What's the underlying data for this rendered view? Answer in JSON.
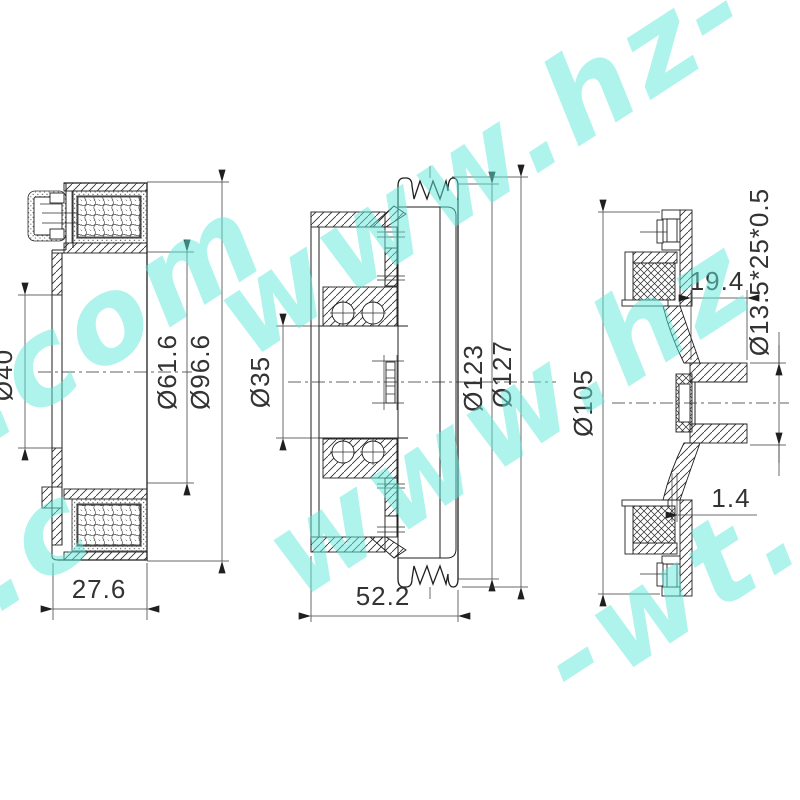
{
  "watermark": {
    "text": "www.hz-wt.com",
    "color": "#5fe8db",
    "fragments": [
      {
        "text": "t.com"
      },
      {
        "text": "www.hz-"
      },
      {
        "text": "www.hz"
      },
      {
        "text": "-wt."
      },
      {
        "text": "t.c"
      }
    ]
  },
  "views": {
    "coil": {
      "dims": {
        "bore": "Ø40",
        "coil_inner": "Ø61.6",
        "outer": "Ø96.6",
        "width": "27.6"
      }
    },
    "pulley": {
      "dims": {
        "bore": "Ø35",
        "groove_root": "Ø123",
        "outer": "Ø127",
        "width": "52.2"
      }
    },
    "hub": {
      "dims": {
        "outer": "Ø105",
        "hub_depth": "19.4",
        "bearing_spec": "Ø13.5*25*0.5",
        "air_gap": "1.4"
      }
    }
  }
}
